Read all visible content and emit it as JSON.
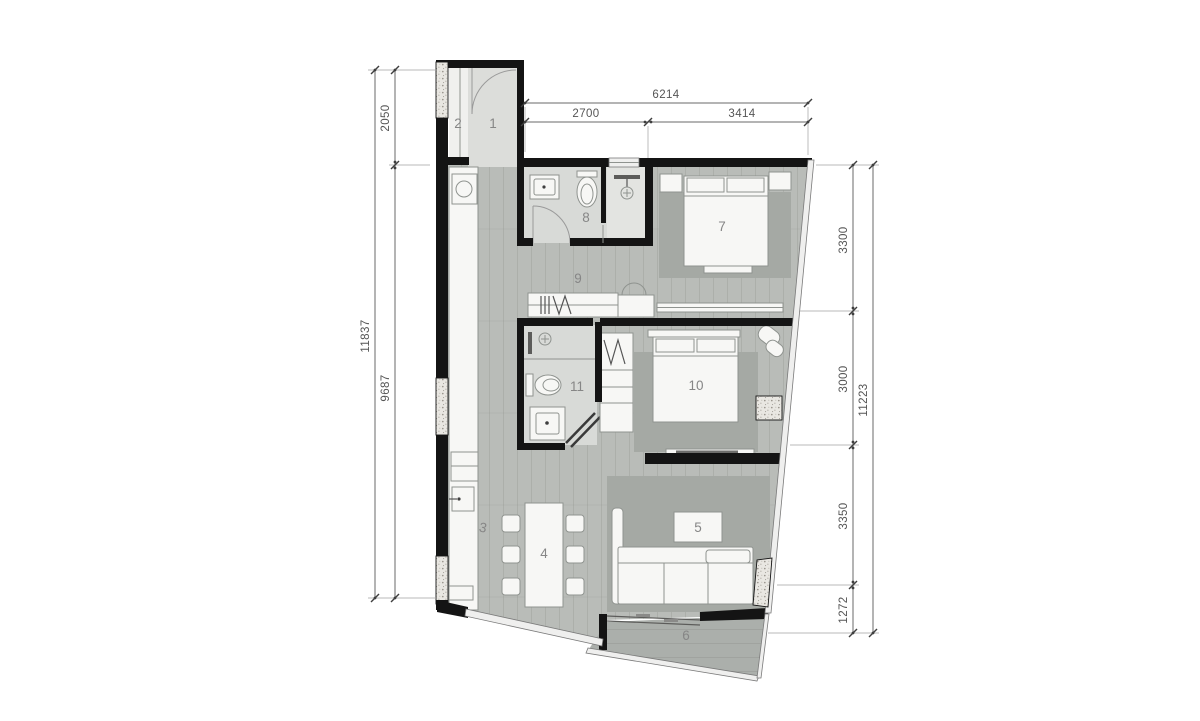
{
  "document": {
    "background": "#ffffff"
  },
  "palette": {
    "wall": "#141414",
    "floor_wood": "#b9bcb8",
    "floor_bath": "#d8dad7",
    "floor_entry": "#dcddda",
    "floor_balcony": "#abafab",
    "rug": "#a5a9a4",
    "furniture_fill": "#f7f7f5",
    "furniture_stroke": "#8f938f",
    "glazing": "#efefee",
    "dimension_text": "#555555",
    "room_label": "#868686"
  },
  "rooms": [
    {
      "number": "1"
    },
    {
      "number": "2"
    },
    {
      "number": "3"
    },
    {
      "number": "4"
    },
    {
      "number": "5"
    },
    {
      "number": "6"
    },
    {
      "number": "7"
    },
    {
      "number": "8"
    },
    {
      "number": "9"
    },
    {
      "number": "10"
    },
    {
      "number": "11"
    }
  ],
  "dimensions": {
    "top": {
      "total": "6214",
      "segments": [
        "2700",
        "3414"
      ]
    },
    "left": {
      "outer_total": "11837",
      "top_segment": "2050",
      "main_segment": "9687"
    },
    "right": {
      "outer_total": "11223",
      "segments": [
        "3300",
        "3000",
        "3350",
        "1272"
      ]
    }
  }
}
